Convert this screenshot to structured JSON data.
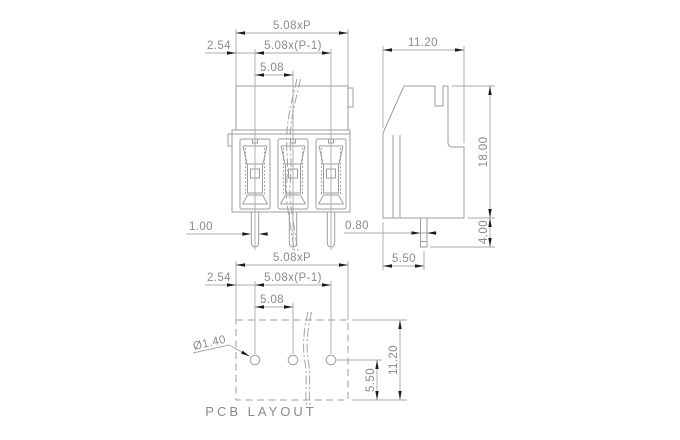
{
  "drawing_type": "terminal-block-dimension-drawing",
  "colors": {
    "background": "#ffffff",
    "line": "#9e9e9e",
    "text": "#8a8a8a",
    "arrow": "#1c1c1c"
  },
  "front_view": {
    "dim_total": "5.08xP",
    "dim_span": "5.08x(P-1)",
    "dim_pitch": "5.08",
    "dim_offset": "2.54",
    "dim_pin_width": "1.00"
  },
  "side_view": {
    "dim_width": "11.20",
    "dim_height": "18.00",
    "dim_pin_length": "4.00",
    "dim_pin_offset": "5.50",
    "dim_pin_width": "0.80"
  },
  "pcb_layout": {
    "label": "PCB LAYOUT",
    "dim_total": "5.08xP",
    "dim_span": "5.08x(P-1)",
    "dim_pitch": "5.08",
    "dim_offset": "2.54",
    "dim_hole_dia": "Ø1.40",
    "dim_hole_offset": "5.50",
    "dim_depth": "11.20"
  }
}
